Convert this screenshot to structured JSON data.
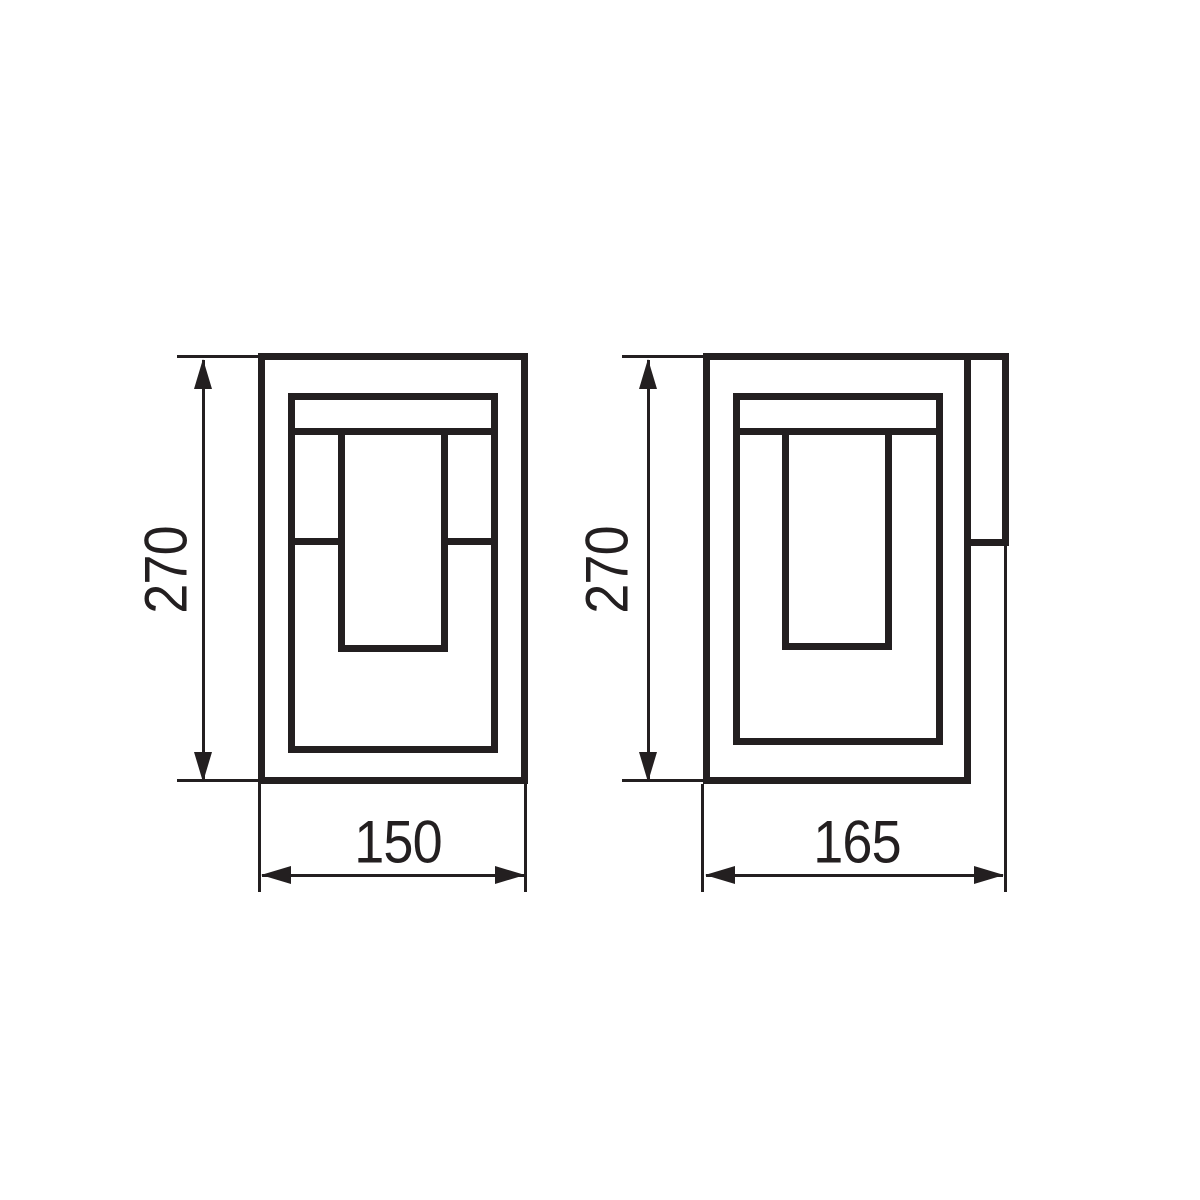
{
  "drawing": {
    "kind": "technical-dimension-drawing",
    "subject": "rectangular wall lantern luminaire, two orthographic views",
    "background_color": "#ffffff",
    "line_color": "#231f20"
  },
  "views": [
    {
      "name": "front",
      "dimensions": [
        {
          "axis": "height",
          "value": "270"
        },
        {
          "axis": "width",
          "value": "150"
        }
      ]
    },
    {
      "name": "side",
      "dimensions": [
        {
          "axis": "height",
          "value": "270"
        },
        {
          "axis": "depth",
          "value": "165"
        }
      ]
    }
  ]
}
